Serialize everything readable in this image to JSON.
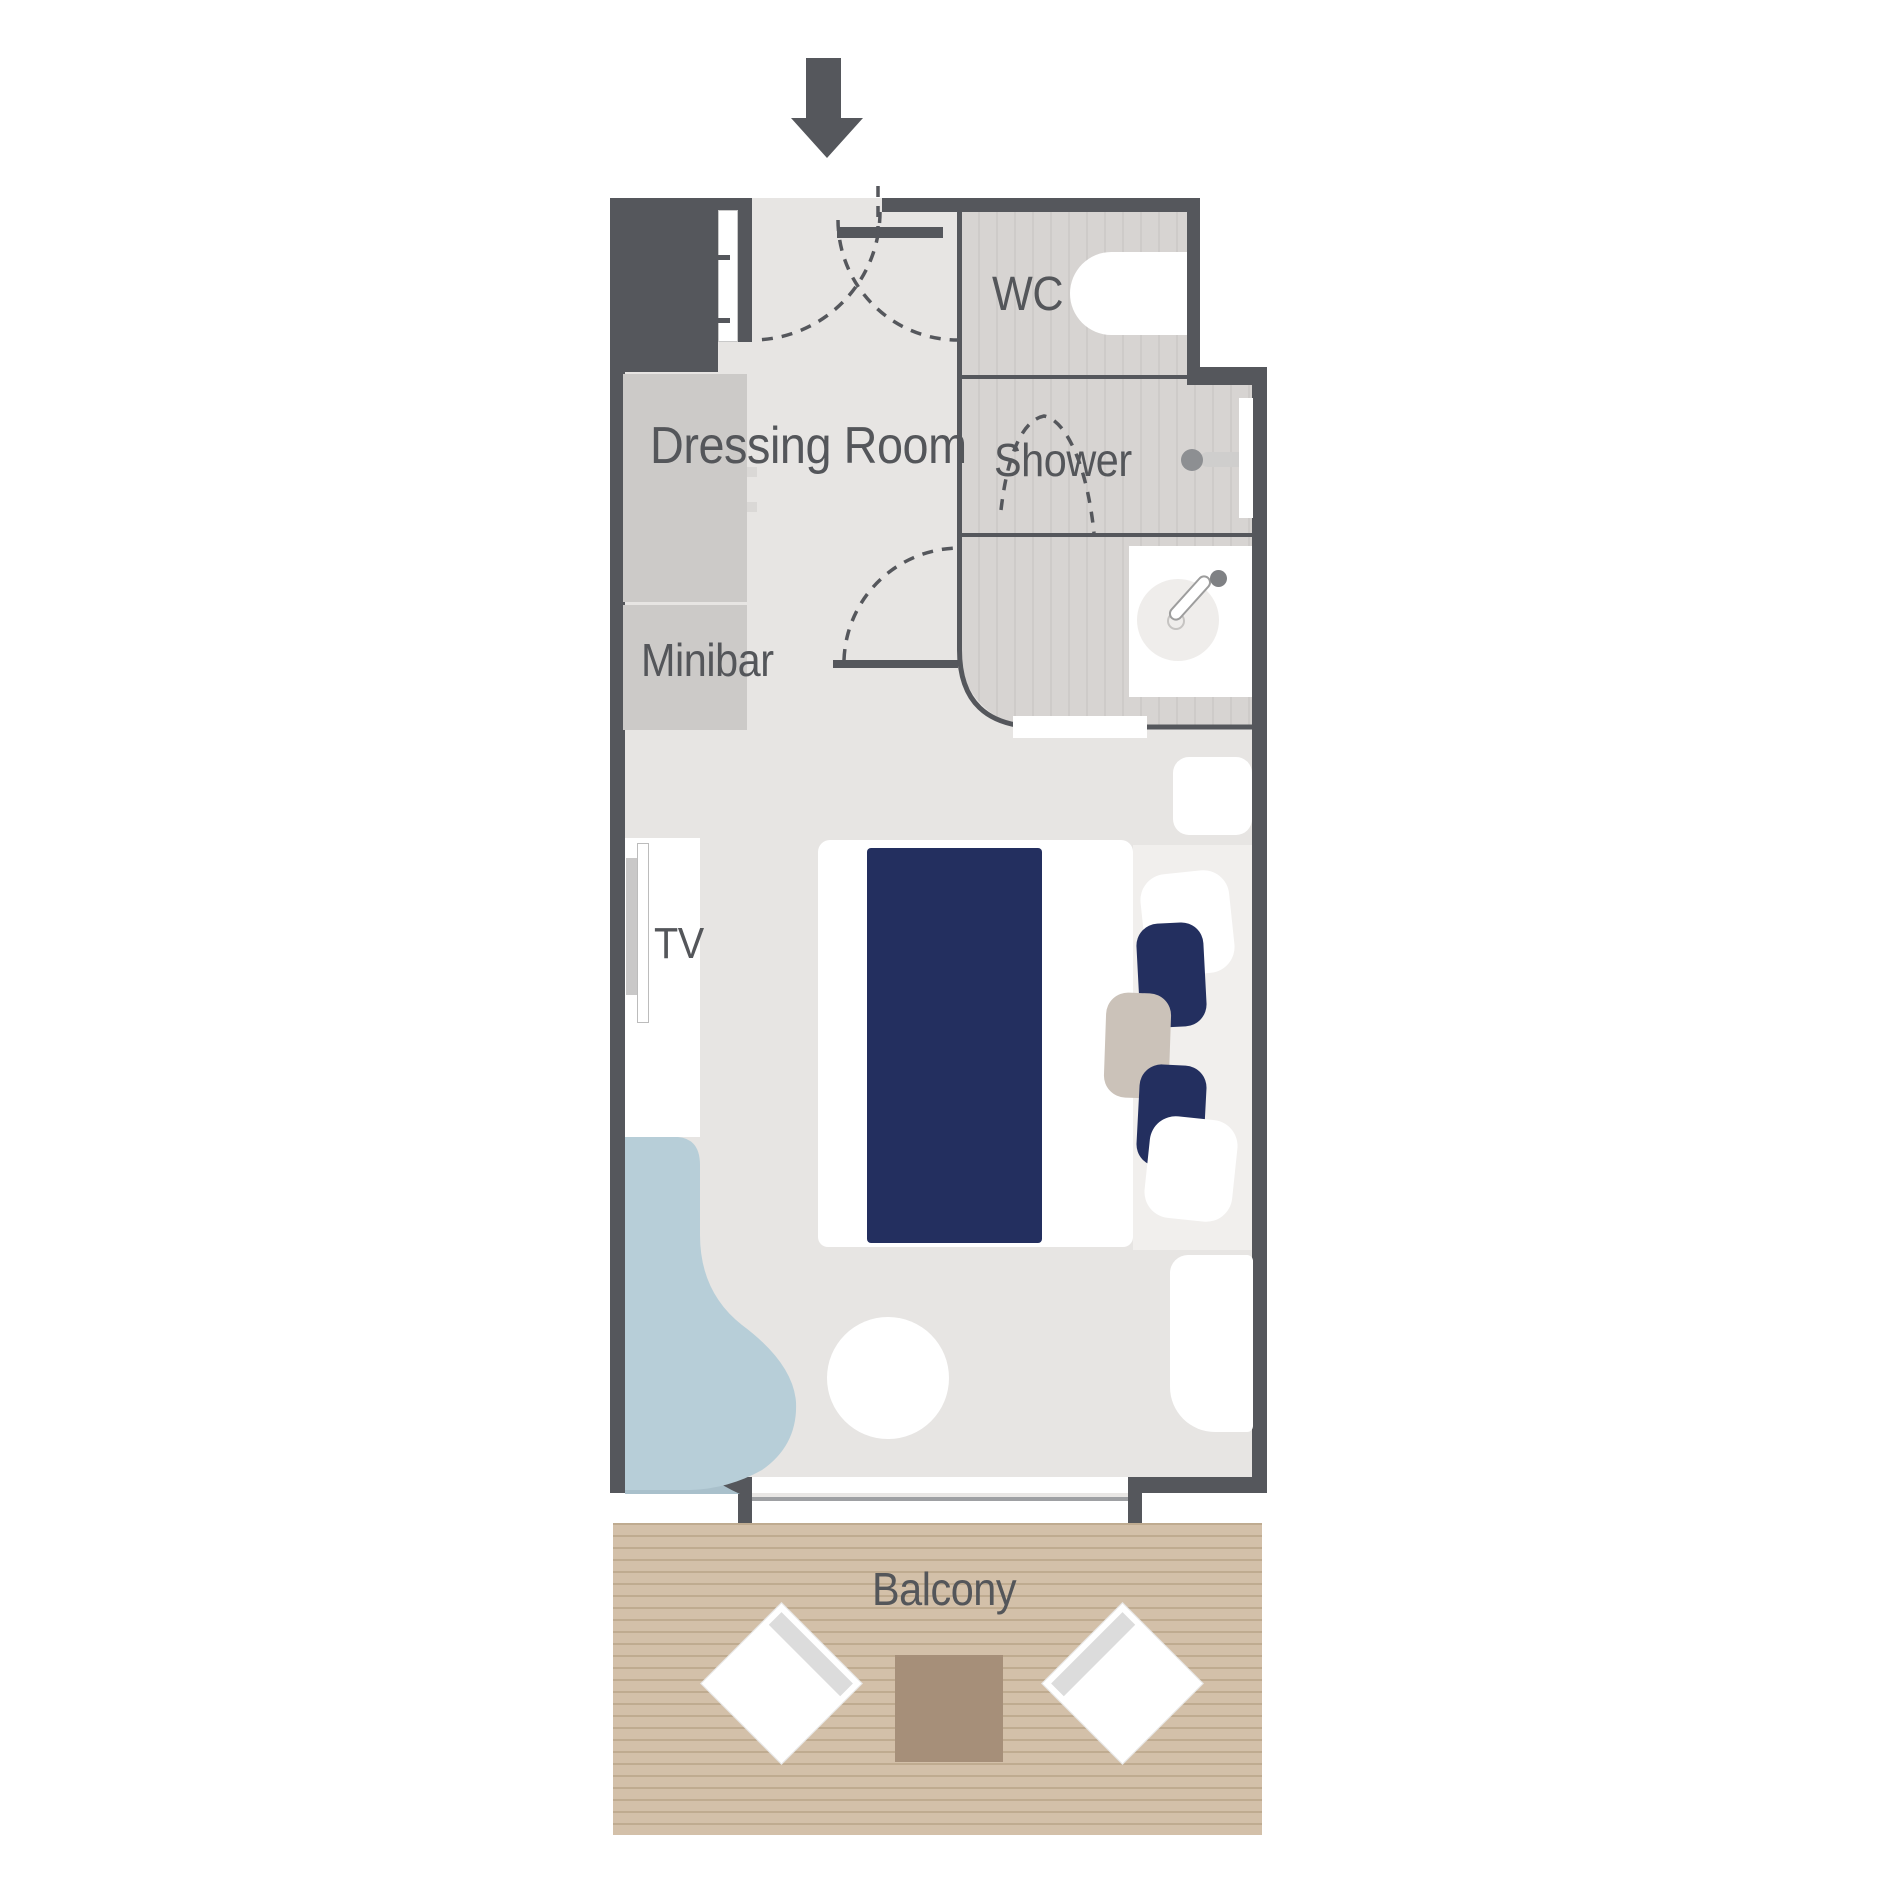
{
  "page": {
    "kind": "stateroom-floor-plan",
    "background": "#ffffff"
  },
  "labels": {
    "dressing_room": "Dressing Room",
    "minibar": "Minibar",
    "tv": "TV",
    "wc": "WC",
    "shower": "Shower",
    "balcony": "Balcony"
  },
  "colors": {
    "wall": "#55575c",
    "floor": "#e7e5e3",
    "bathroom_floor": "#d7d4d2",
    "bathroom_stripe": "#cecbc9",
    "cabinet_gray": "#cccac8",
    "bed_duvet_navy": "#232f5f",
    "chair_cushion_navy": "#232f5f",
    "chaise_blue": "#b7ced8",
    "chaise_shadow_blue": "#a9c0cb",
    "deck_wood": "#d3c0a9",
    "deck_plank_line": "#bfab90",
    "deck_table_brown": "#a68f79",
    "side_table_beige": "#cbc2b9",
    "rug_light": "#f1efed",
    "label_text": "#54565a",
    "furniture_white": "#ffffff"
  },
  "icons": {
    "entrance_arrow": "down-arrow glyph marking cabin entrance",
    "door_swings": "dashed quarter-circle arcs",
    "toilet": "white pill shape",
    "shower_head": "circle with arm bar",
    "sink": "basin circle with faucet",
    "tv": "thin wall-mounted bar"
  }
}
